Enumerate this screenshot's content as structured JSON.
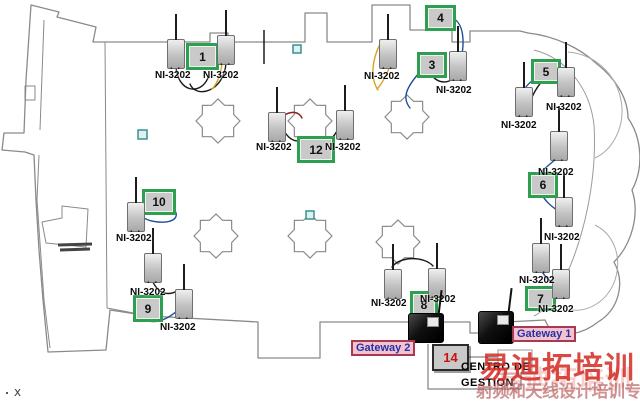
{
  "diagram": {
    "sensor_label": "NI-3202",
    "nodes": {
      "n1": "1",
      "n3": "3",
      "n4": "4",
      "n5": "5",
      "n6": "6",
      "n7": "7",
      "n8": "8",
      "n9": "9",
      "n10": "10",
      "n12": "12",
      "n14": "14"
    },
    "gateways": {
      "gw1": "Gateway 1",
      "gw2": "Gateway 2"
    },
    "control_center": {
      "line1": "CENTRO DE",
      "line2": "GESTION"
    },
    "axis_marker": "x",
    "watermark": {
      "line1": "易迪拓培训",
      "line2": "射频和天线设计培训专家"
    },
    "colors": {
      "node_border": "#2e9e50",
      "node_fill": "#c9c9c9",
      "node_number": "#111111",
      "node14_number": "#cc1111",
      "node14_border": "#2b2b2b",
      "gateway_label_bg": "#f4c2ce",
      "gateway_label_border": "#a63a52",
      "gateway_label_text": "#2233aa",
      "wire_black": "#1a1a1a",
      "wire_blue": "#1f4e9c",
      "wire_orange": "#d9a520",
      "wire_red": "#8b2020",
      "floorplan_outline": "#8a8a8a",
      "marker_teal": "#3a9090",
      "watermark_red": "#d42a22",
      "watermark_faded": "#b05050"
    }
  }
}
